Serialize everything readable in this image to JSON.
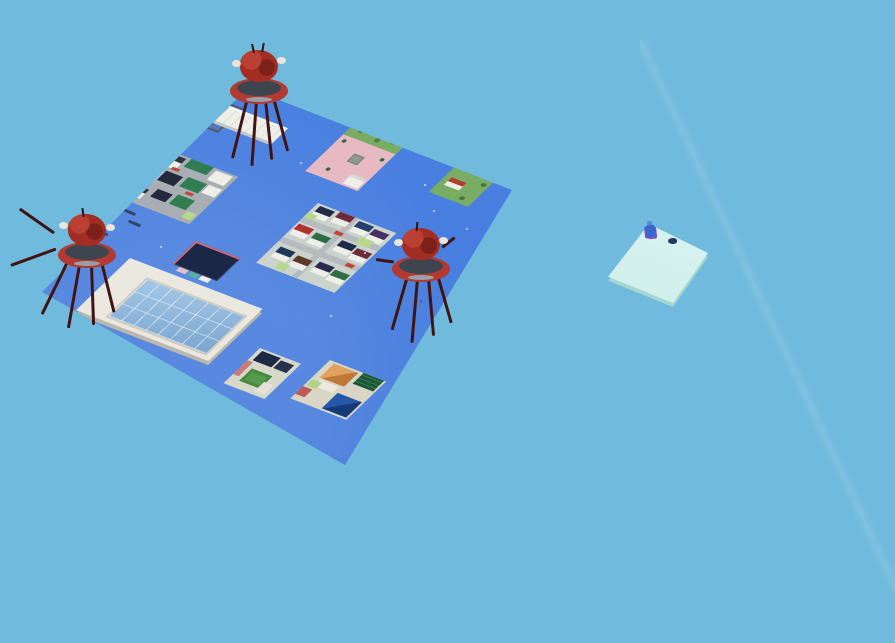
{
  "scene": {
    "type": "game-3d-voxel-world",
    "view": "isometric",
    "description": "floating voxel town island with three crab bosses and a separate spawn platform"
  },
  "colors": {
    "sky": "#70badd",
    "island": "#4d84e4",
    "island-deep": "#4076d8",
    "road": "#a9aeb4",
    "white-wall": "#eeefe9",
    "window-dark": "#2c3240",
    "green-roof": "#2f7d50",
    "navy-roof": "#232a3c",
    "grass": "#79ad63",
    "garden-dark": "#4e8046",
    "yard-green": "#b7d88b",
    "plaza-pink": "#e7bac3",
    "tan-base": "#d9d2c4",
    "purple-roof": "#5c4a78",
    "teal-roof": "#1f6e5e",
    "red-accent": "#c24434",
    "orange-roof": "#e0a05e",
    "orange-roof-dark": "#c07838",
    "blue-roof": "#2558a8",
    "blue-roof-dark": "#143a78",
    "green-court": "#569a4c",
    "glass": "#a4c7e7",
    "glass-line": "#7ba6cf",
    "rim-white": "#eae8df",
    "solar-dark": "#1b2746",
    "solar-trim": "#d06878",
    "crab-red": "#a32d23",
    "crab-rim": "#b23a30",
    "saucer-top": "#3e4550",
    "leg-dark": "#401412",
    "claw-white": "#e9e5da",
    "platform-cyan": "#cfeeea",
    "platform-edge": "#a5d6d2",
    "player-blue": "#3a66cc",
    "player-purple": "#7a4fc0",
    "critter": "#243a66",
    "speck": "#e8f2f6",
    "dock": "#2f4668"
  },
  "entities": {
    "bosses": [
      {
        "name": "crab-boss",
        "location": "north-edge"
      },
      {
        "name": "crab-boss",
        "location": "west-edge"
      },
      {
        "name": "crab-boss",
        "location": "center-east"
      }
    ],
    "player": {
      "name": "player-character",
      "location": "spawn-platform"
    },
    "critter": {
      "name": "small-critter",
      "location": "spawn-platform"
    },
    "platforms": [
      {
        "name": "town-island",
        "shape": "large-blue-quad"
      },
      {
        "name": "spawn-platform",
        "shape": "small-cyan-quad"
      }
    ],
    "districts": [
      "crane-yard",
      "warehouse",
      "commercial-block",
      "plaza-park",
      "purple-roof-house-tile",
      "garden-pavilion-tile",
      "residential-grid",
      "dark-tower",
      "greenhouse",
      "courtyard-tile",
      "temple-roofs-tile"
    ]
  }
}
